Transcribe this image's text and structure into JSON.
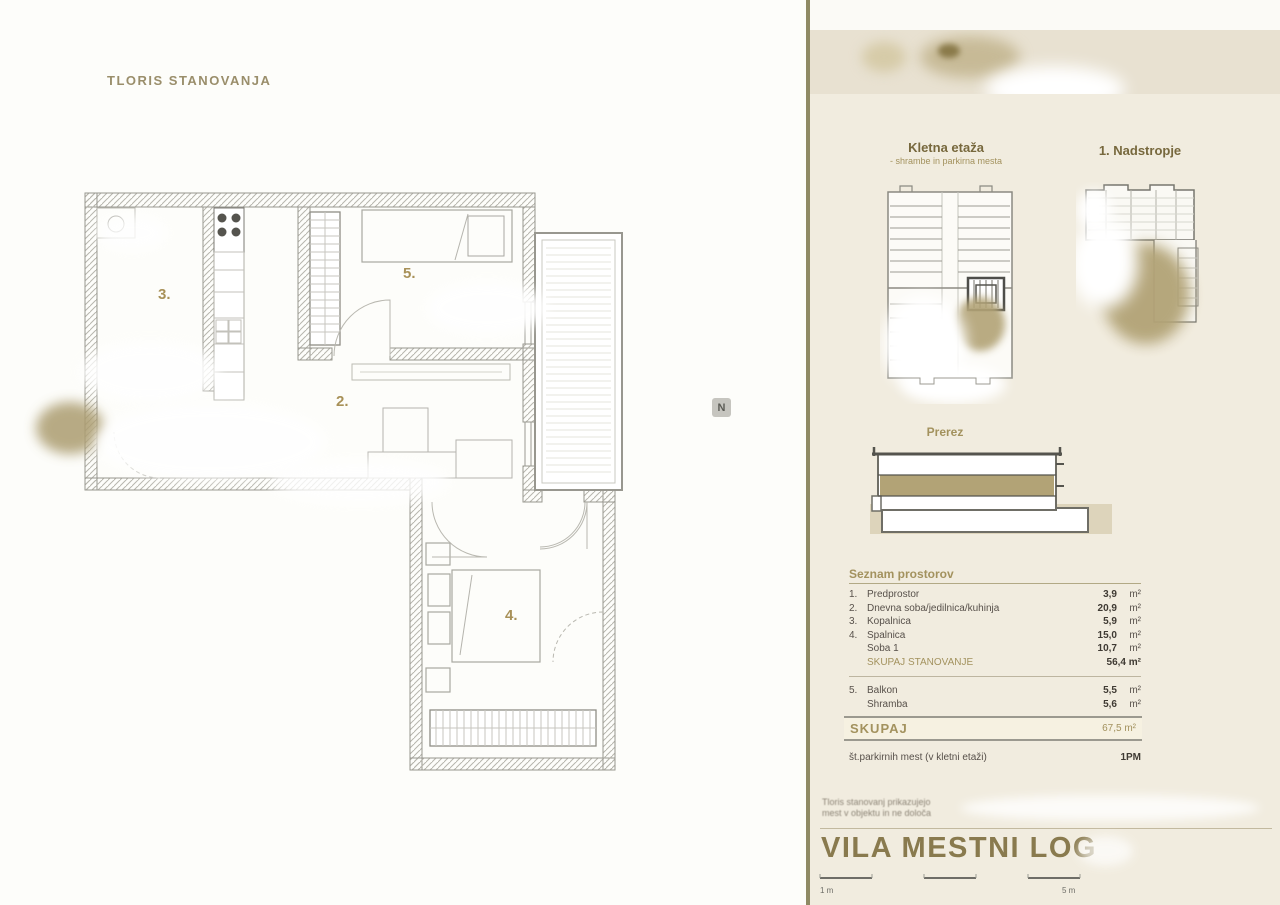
{
  "plan": {
    "title": "TLORIS STANOVANJA",
    "room_labels": {
      "bathroom": "3.",
      "room1": "5.",
      "living": "2.",
      "bedroom": "4."
    },
    "north_label": "N"
  },
  "sidebar": {
    "basement": {
      "title": "Kletna etaža",
      "subtitle": "- shrambe in parkirna mesta"
    },
    "first_floor": {
      "title": "1. Nadstropje"
    },
    "section": {
      "title": "Prerez"
    },
    "room_list": {
      "header": "Seznam prostorov",
      "rows": [
        {
          "no": "1.",
          "name": "Predprostor",
          "value": "3,9",
          "unit": "m²"
        },
        {
          "no": "2.",
          "name": "Dnevna soba/jedilnica/kuhinja",
          "value": "20,9",
          "unit": "m²"
        },
        {
          "no": "3.",
          "name": "Kopalnica",
          "value": "5,9",
          "unit": "m²"
        },
        {
          "no": "4.",
          "name": "Spalnica",
          "value": "15,0",
          "unit": "m²"
        },
        {
          "no": "",
          "name": "Soba 1",
          "value": "10,7",
          "unit": "m²"
        }
      ],
      "subtotal": {
        "name": "SKUPAJ STANOVANJE",
        "value": "56,4 m²"
      },
      "rows2": [
        {
          "no": "5.",
          "name": "Balkon",
          "value": "5,5",
          "unit": "m²"
        },
        {
          "no": "",
          "name": "Shramba",
          "value": "5,6",
          "unit": "m²"
        }
      ]
    },
    "total": {
      "label": "SKUPAJ",
      "value": "67,5 m²"
    },
    "parking": {
      "label": "št.parkirnih mest (v kletni etaži)",
      "value": "1PM"
    },
    "disclaimer": {
      "line1": "Tloris stanovanj prikazujejo",
      "line2": "mest v objektu in ne določa"
    },
    "project_title": "VILA MESTNI LOG",
    "scale": {
      "left": "1 m",
      "right": "5 m"
    }
  },
  "colors": {
    "accent": "#a3925e",
    "header_brown": "#77683d",
    "highlight": "#b2a376",
    "sidebar_bg": "#f1ecdf",
    "ground": "#ddd4bb"
  }
}
